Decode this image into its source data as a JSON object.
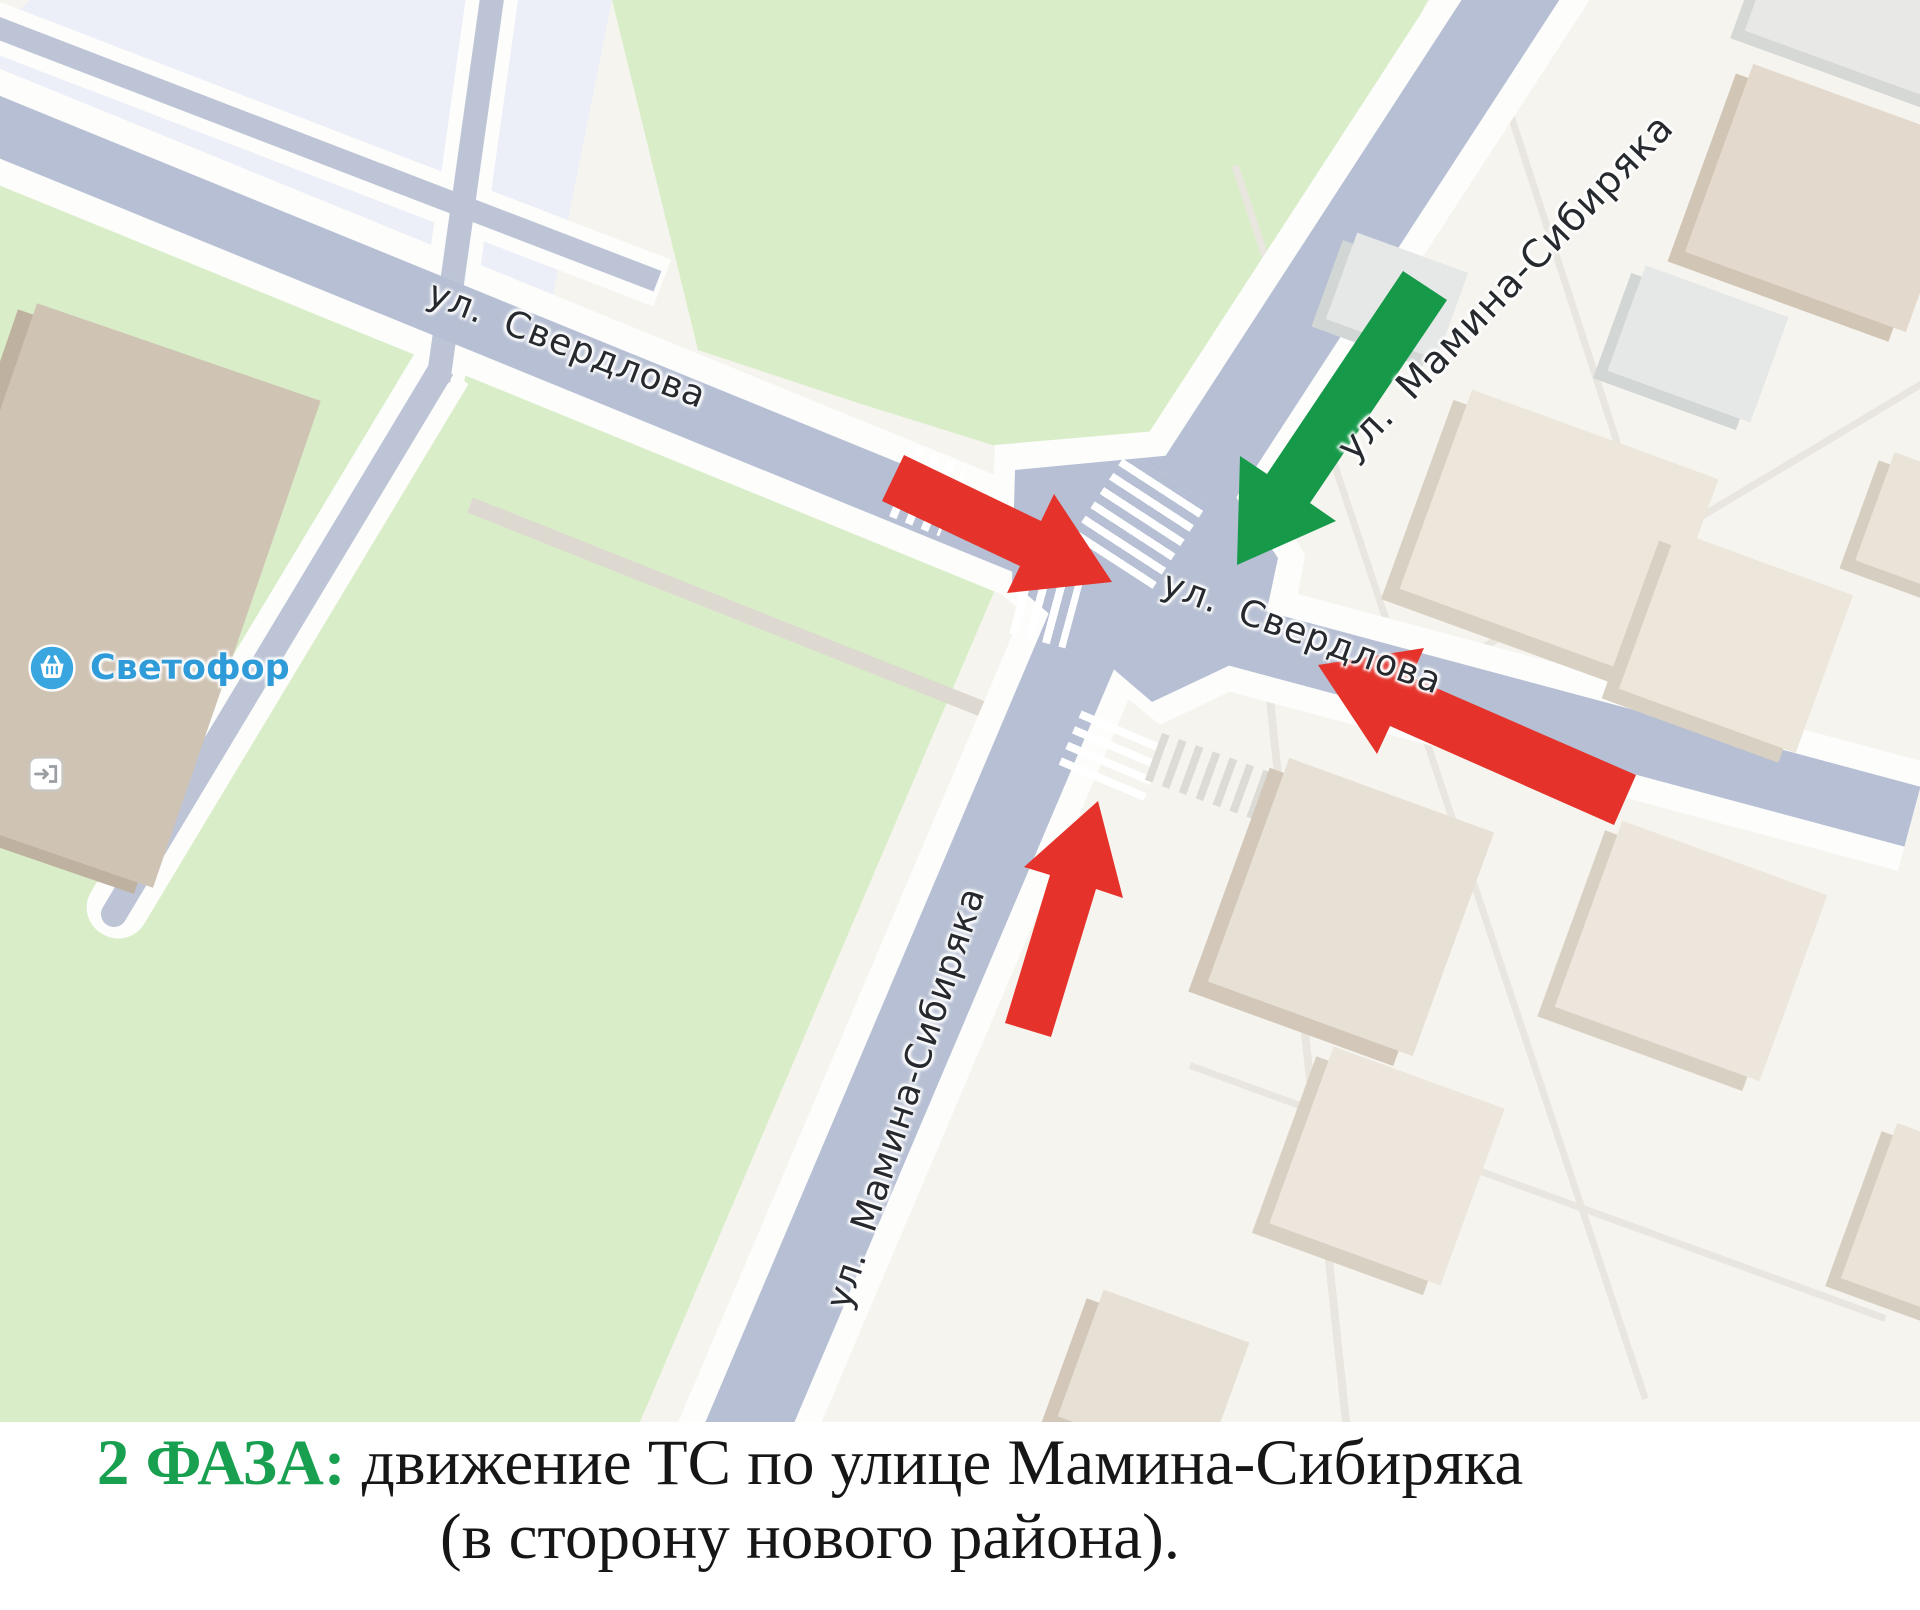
{
  "map": {
    "street_labels": [
      {
        "id": "sverdlova-west",
        "text": "ул. Свердлова"
      },
      {
        "id": "sverdlova-east",
        "text": "ул. Свердлова"
      },
      {
        "id": "mamina-north",
        "text": "ул. Мамина-Сибиряка"
      },
      {
        "id": "mamina-south",
        "text": "ул. Мамина-Сибиряка"
      }
    ],
    "poi": {
      "label": "Светофор",
      "icon": "shopping-basket-icon",
      "color": "#2f9bd8"
    },
    "arrows": [
      {
        "id": "red-arrow-sverdlova-eastbound",
        "color": "#e5322a"
      },
      {
        "id": "red-arrow-sverdlova-westbound",
        "color": "#e5322a"
      },
      {
        "id": "red-arrow-mamina-northbound",
        "color": "#e5322a"
      },
      {
        "id": "green-arrow-mamina-southbound",
        "color": "#169a4a"
      }
    ],
    "colors": {
      "road": "#b6bfd3",
      "park": "#d9eec8",
      "background": "#f6f4ef",
      "block": "#edeff8"
    }
  },
  "caption": {
    "phase_label": "2 ФАЗА:",
    "phase_color": "#18a050",
    "line1": "движение ТС по улице Мамина-Сибиряка",
    "line2": "(в сторону нового района)."
  }
}
